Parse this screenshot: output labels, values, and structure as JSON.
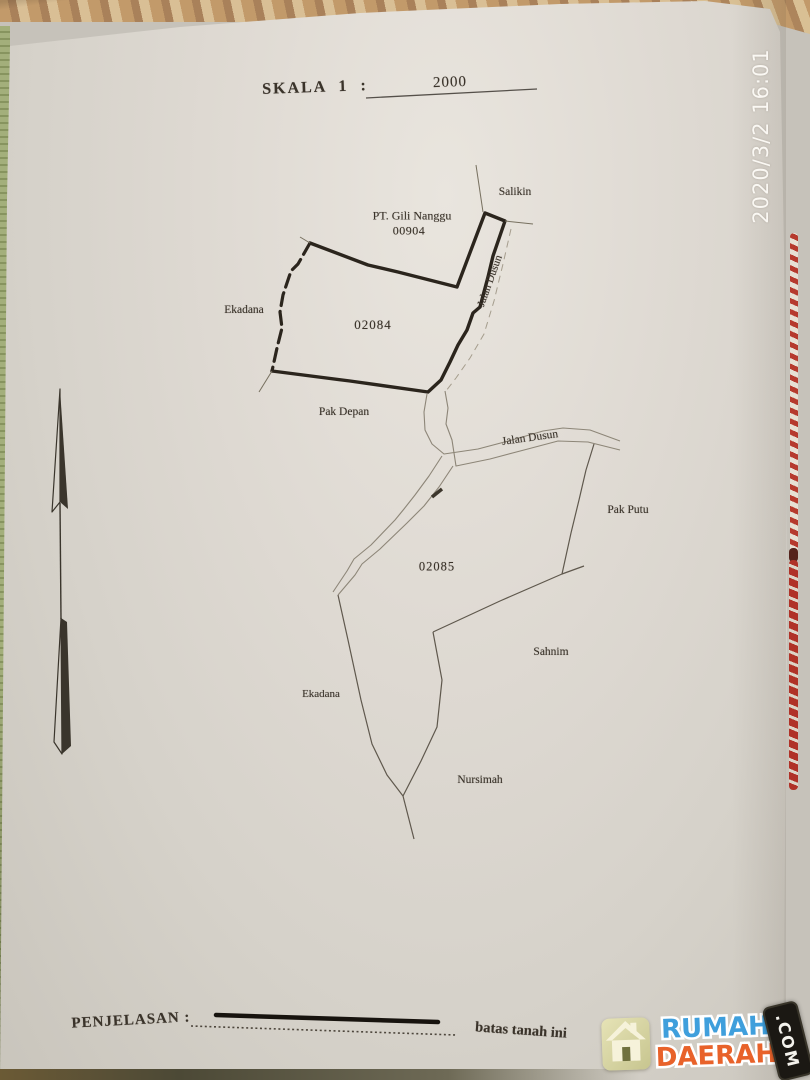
{
  "overlay": {
    "timestamp": "2020/3/2  16:01",
    "watermark": {
      "word_top": "RUMAH",
      "word_bottom": "DAERAH",
      "badge": ".COM",
      "icon": "house-icon",
      "color_top": "#3f9fdc",
      "color_bottom": "#e8622a",
      "badge_bg": "#1b1813",
      "tile_bg": "#d9d7a4"
    }
  },
  "document": {
    "scale": {
      "label": "SKALA 1 :",
      "value": "2000"
    },
    "compass": {
      "type": "north-arrow"
    },
    "parcels": [
      {
        "id": "02084",
        "owner": "PT. Gili Nanggu",
        "certificate": "00904",
        "neighbor_north": "Salikin",
        "neighbor_west": "Ekadana",
        "neighbor_south": "Pak Depan",
        "road_east": "Jalan Dusun"
      },
      {
        "id": "02085",
        "neighbor_east": "Pak Putu",
        "neighbor_southeast": "Sahnim",
        "neighbor_west": "Ekadana",
        "neighbor_south": "Nursimah",
        "road_north": "Jalan Dusun"
      }
    ],
    "legend": {
      "label": "PENJELASAN :",
      "note": "batas tanah ini"
    }
  }
}
